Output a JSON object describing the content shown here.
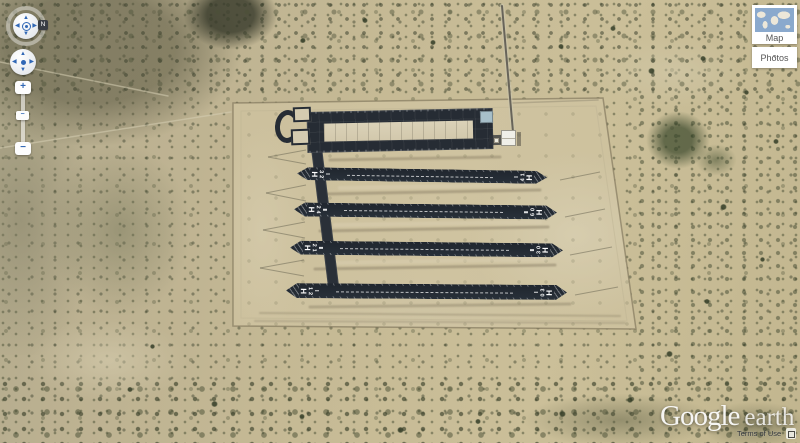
{
  "app": {
    "title": "Google Earth"
  },
  "navigation": {
    "compass_label": "N",
    "zoom_in_label": "+",
    "zoom_out_label": "−",
    "zoom_thumb_label": "−"
  },
  "overview_controls": {
    "map_label": "Map",
    "photos_label": "Photos",
    "photos_caret": "▾"
  },
  "watermark": {
    "brand": "Google",
    "product": "earth",
    "terms_label": "Terms of Use"
  },
  "airfield": {
    "runways": [
      {
        "left_h": "H",
        "left_digit_top": "3",
        "left_digit_bottom": "2",
        "right_digit_top": "1",
        "right_digit_bottom": "4",
        "right_h": "H"
      },
      {
        "left_h": "H",
        "left_digit_top": "2",
        "left_digit_bottom": "4",
        "right_digit_top": "0",
        "right_digit_bottom": "6",
        "right_h": "H"
      },
      {
        "left_h": "H",
        "left_digit_top": "2",
        "left_digit_bottom": "1",
        "right_digit_top": "0",
        "right_digit_bottom": "3",
        "right_h": "H"
      },
      {
        "left_h": "H",
        "left_digit_top": "1",
        "left_digit_bottom": "2",
        "right_digit_top": "3",
        "right_digit_bottom": "0",
        "right_h": "H"
      }
    ]
  },
  "icons": {
    "arrow_up": "▲",
    "arrow_down": "▼",
    "arrow_left": "◀",
    "arrow_right": "▶"
  },
  "colors": {
    "asphalt": "#262c34",
    "runway_asphalt": "#20262e",
    "concrete": "#dbd2b8",
    "blue_pad": "#a7bfc9",
    "control_blue": "#3067b5",
    "panel_white": "#ffffff",
    "label_gray": "#555555",
    "ocean_blue": "#8aa9cd"
  }
}
